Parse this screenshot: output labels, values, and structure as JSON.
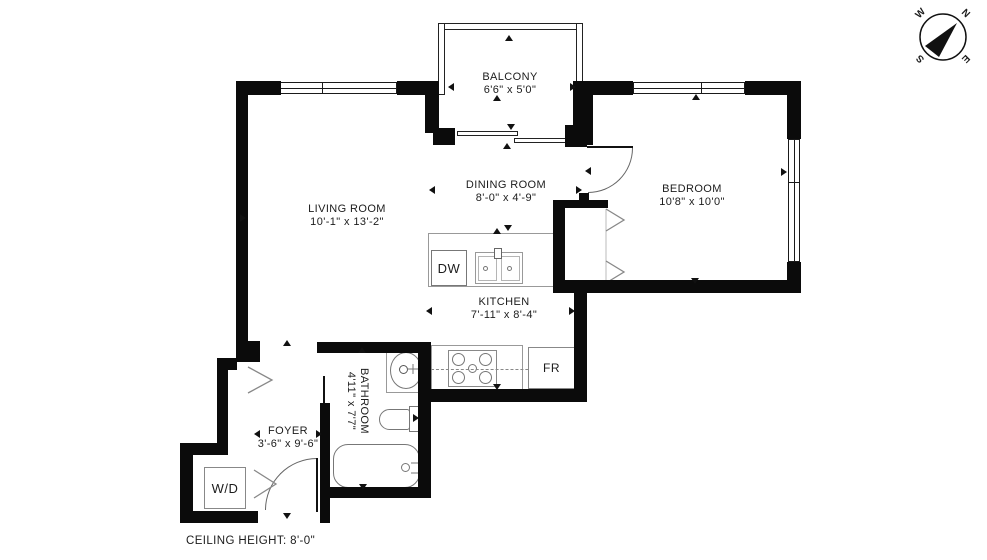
{
  "floorplan": {
    "rooms": [
      {
        "name": "BALCONY",
        "dims": "6'6\" x 5'0\""
      },
      {
        "name": "LIVING ROOM",
        "dims": "10'-1\" x 13'-2\""
      },
      {
        "name": "DINING ROOM",
        "dims": "8'-0\" x 4'-9\""
      },
      {
        "name": "BEDROOM",
        "dims": "10'8\" x 10'0\""
      },
      {
        "name": "KITCHEN",
        "dims": "7'-11\" x 8'-4\""
      },
      {
        "name": "BATHROOM",
        "dims": "4'11\" x 7'7\""
      },
      {
        "name": "FOYER",
        "dims": "3'-6\" x 9'-6\""
      }
    ],
    "appliances": {
      "dishwasher": "DW",
      "fridge": "FR",
      "washer_dryer": "W/D"
    },
    "ceiling_note": "CEILING HEIGHT: 8'-0\"",
    "compass": {
      "west": "W",
      "north": "N",
      "south": "S",
      "east": "E"
    },
    "colors": {
      "wall": "#0b0b0b",
      "fixture_line": "#8a8a8a",
      "text": "#1c1c1c",
      "background": "#ffffff"
    }
  }
}
